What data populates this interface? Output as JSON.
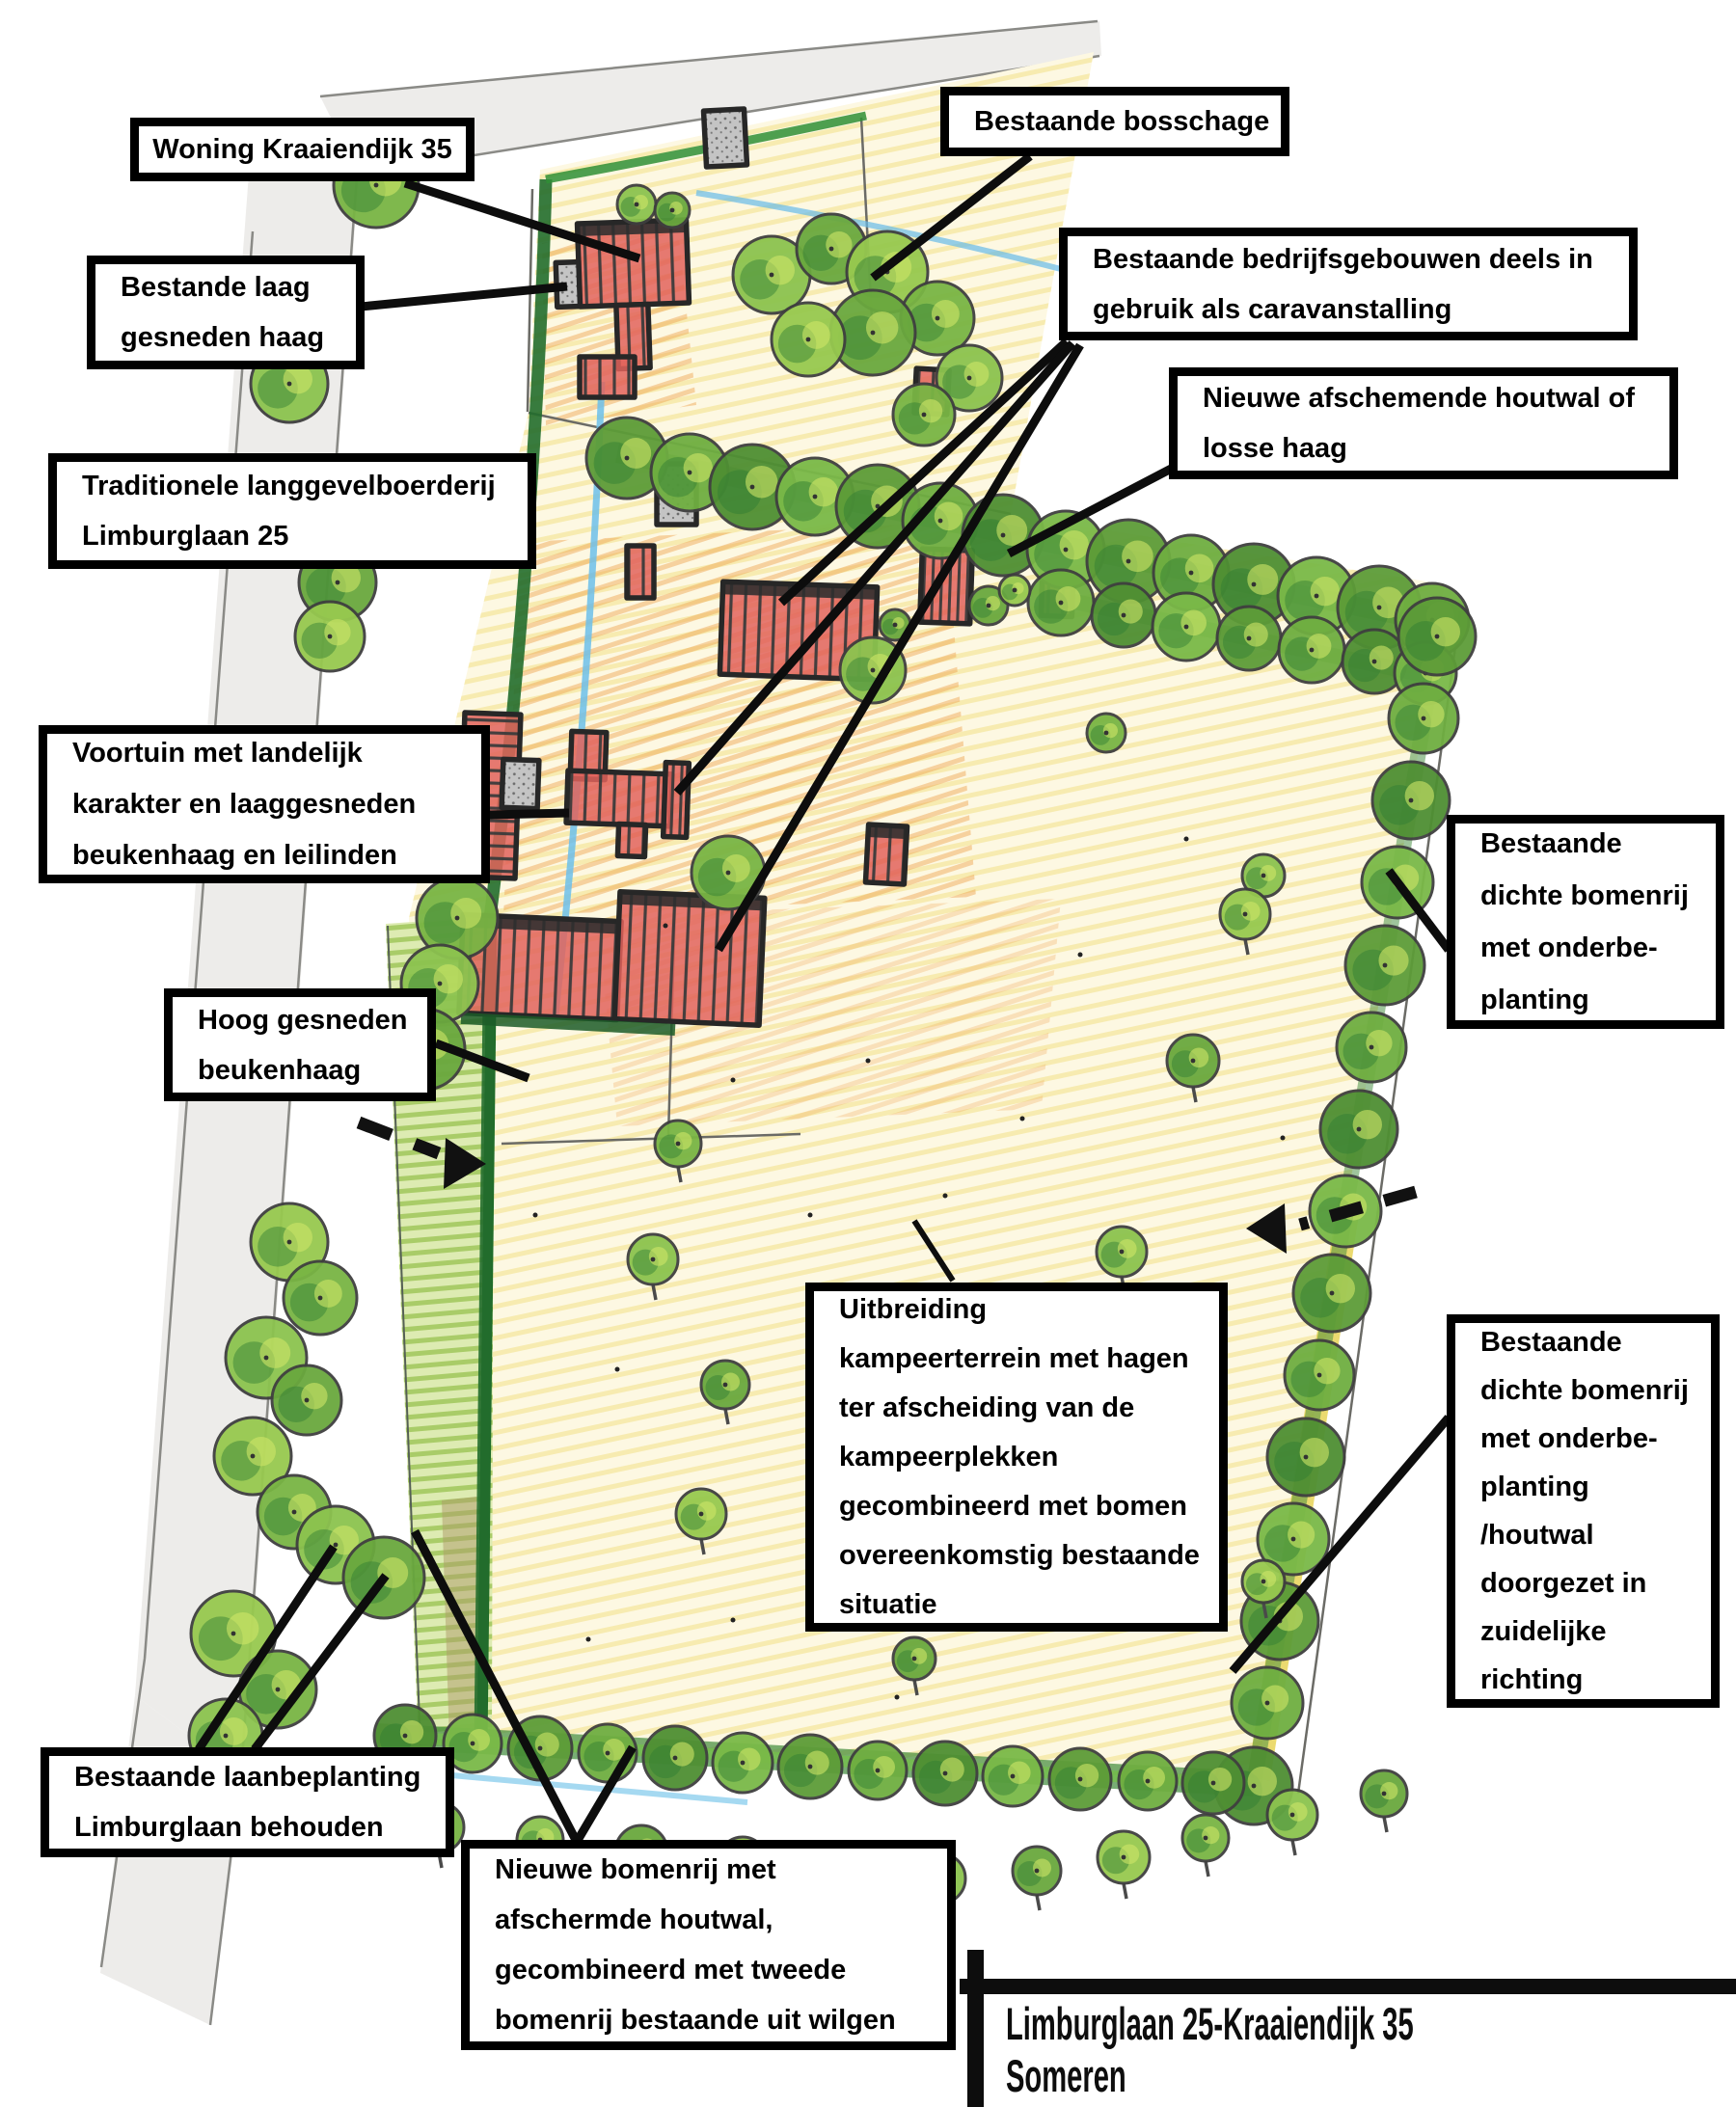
{
  "annotations": [
    {
      "id": "woning-kraaiendijk-35",
      "lines": [
        "Woning Kraaiendijk 35"
      ]
    },
    {
      "id": "bestande-laag-gesneden-haag",
      "lines": [
        "Bestande laag",
        "gesneden haag"
      ]
    },
    {
      "id": "bestaande-bosschage",
      "lines": [
        "Bestaande bosschage"
      ]
    },
    {
      "id": "bestaande-bedrijfsgebouwen",
      "lines": [
        "Bestaande bedrijfsgebouwen deels in",
        "gebruik als caravanstalling"
      ]
    },
    {
      "id": "nieuwe-houtwal",
      "lines": [
        "Nieuwe afschemende houtwal of",
        "losse haag"
      ]
    },
    {
      "id": "langgevelboerderij",
      "lines": [
        "Traditionele langgevelboerderij",
        "Limburglaan 25"
      ]
    },
    {
      "id": "voortuin",
      "lines": [
        "Voortuin met landelijk",
        "karakter en laaggesneden",
        "beukenhaag en leilinden"
      ]
    },
    {
      "id": "hoog-gesneden-beukenhaag",
      "lines": [
        "Hoog gesneden",
        "beukenhaag"
      ]
    },
    {
      "id": "bomenrij-noord",
      "lines": [
        "Bestaande",
        "dichte bomenrij",
        "met onderbe-",
        "planting"
      ]
    },
    {
      "id": "uitbreiding-kampeerterrein",
      "lines": [
        "Uitbreiding",
        "kampeerterrein met hagen",
        "ter afscheiding van de",
        "kampeerplekken",
        "gecombineerd met bomen",
        "overeenkomstig bestaande",
        "situatie"
      ]
    },
    {
      "id": "bomenrij-zuid",
      "lines": [
        "Bestaande",
        "dichte bomenrij",
        "met onderbe-",
        "planting",
        "/houtwal",
        "doorgezet in",
        "zuidelijke",
        "richting"
      ]
    },
    {
      "id": "laanbeplanting",
      "lines": [
        "Bestaande laanbeplanting",
        "Limburglaan behouden"
      ]
    },
    {
      "id": "nieuwe-bomenrij",
      "lines": [
        "Nieuwe bomenrij met",
        "afschermde houtwal,",
        "gecombineerd met tweede",
        "bomenrij bestaande uit wilgen"
      ]
    }
  ],
  "title_block": {
    "line1": "Limburglaan 25-Kraaiendijk 35",
    "line2": "Someren"
  },
  "colors": {
    "box_border": "#000000",
    "box_bg": "#ffffff",
    "leader": "#0d0d0d",
    "roof_red": "#e2635c",
    "tree_green": "#79b544",
    "hedge_dark": "#226d2c",
    "field_yellow": "#f0dd7e",
    "orange_hatch": "#efa959",
    "water_blue": "#6cc0ea",
    "road_gray": "#edecea"
  }
}
